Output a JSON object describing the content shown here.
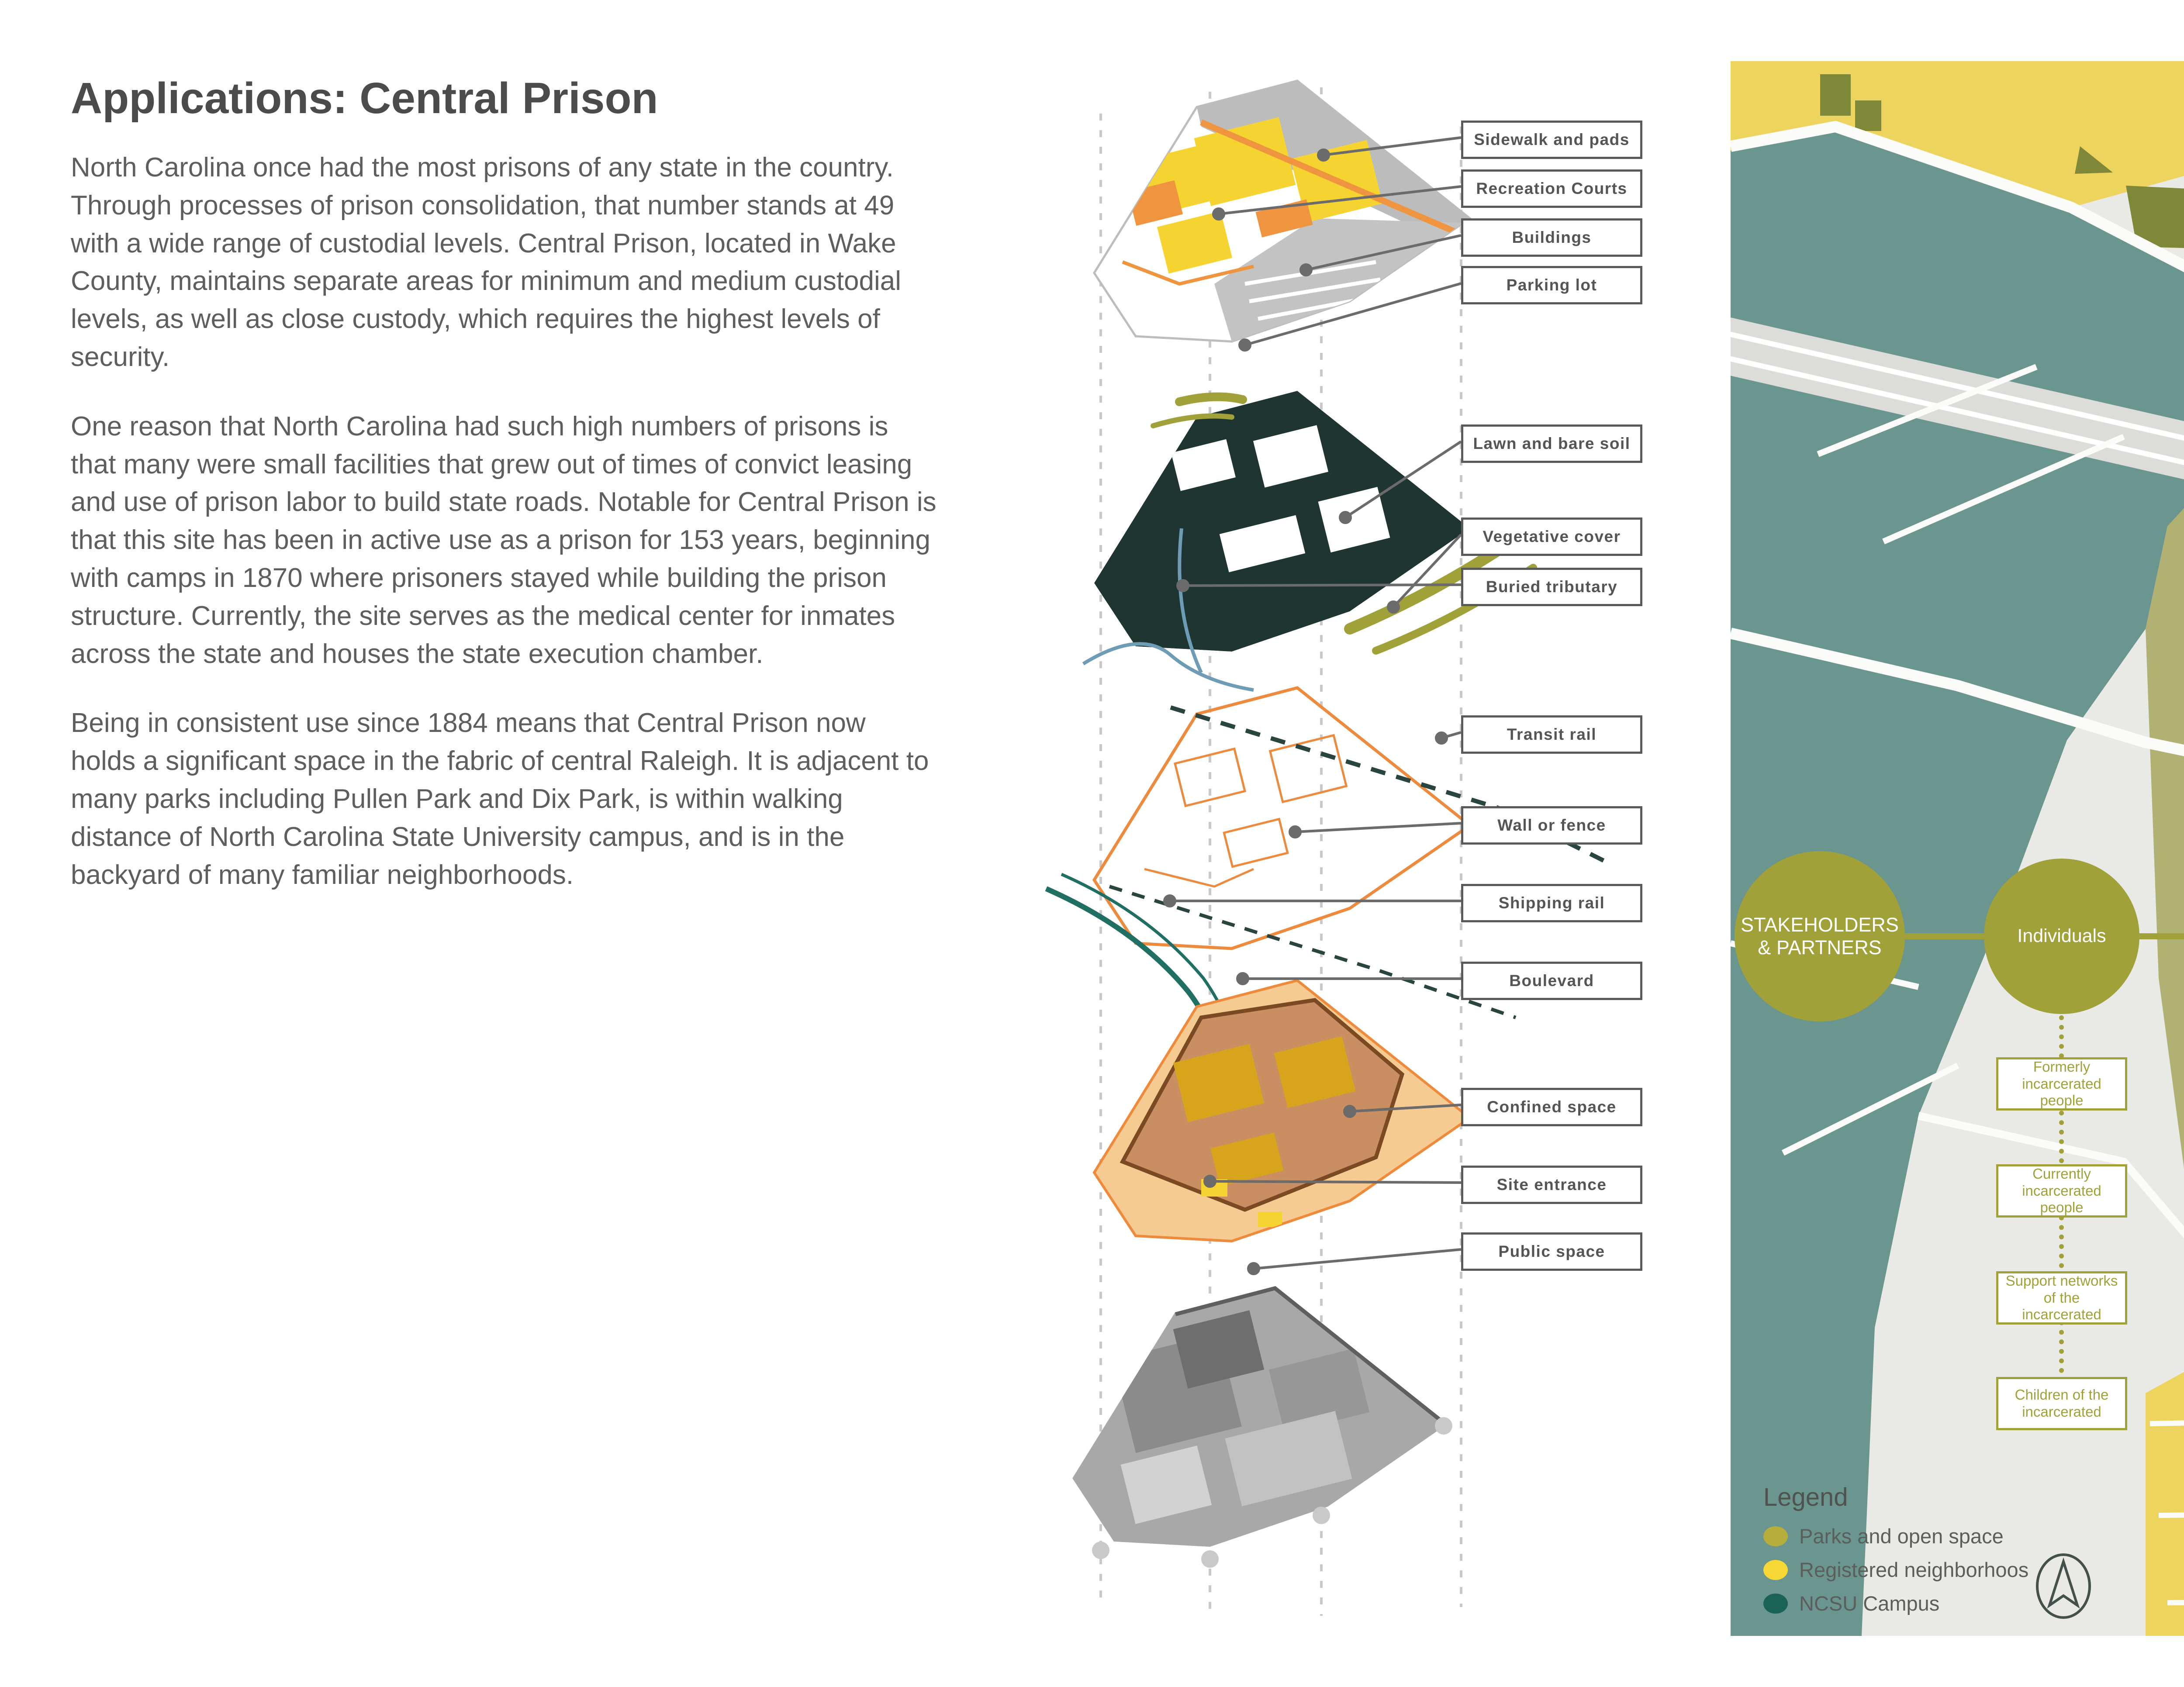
{
  "content": {
    "title": "Applications: Central Prison",
    "paragraphs": [
      "North Carolina once had the most prisons of any state in the country. Through processes of prison consolidation, that number stands at 49 with a wide range of custodial levels. Central Prison, located in Wake County, maintains separate areas for minimum and medium custodial levels, as well as close custody, which requires the highest levels of security.",
      "One reason that North Carolina had such high numbers of prisons is that many were small facilities that grew out of times of convict leasing and use of prison labor to build state roads. Notable for Central Prison is that this site has been in active use as a prison for 153 years, beginning with camps in 1870 where prisoners stayed while building the prison structure. Currently, the site serves as the medical center for inmates across the state and houses the state execution chamber.",
      "Being in consistent use since 1884 means that Central Prison now holds a significant space in the fabric of central Raleigh. It is adjacent to many parks including Pullen Park and Dix Park, is within walking distance of North Carolina State University campus, and is in the backyard of many familiar neighborhoods."
    ]
  },
  "diagram": {
    "labels": [
      "Sidewalk and pads",
      "Recreation Courts",
      "Buildings",
      "Parking lot",
      "Lawn and bare soil",
      "Vegetative cover",
      "Buried tributary",
      "Transit rail",
      "Wall or fence",
      "Shipping rail",
      "Boulevard",
      "Confined space",
      "Site entrance",
      "Public space"
    ]
  },
  "map": {
    "network": {
      "root": "STAKEHOLDERS & PARTNERS",
      "columns": [
        {
          "label": "Individuals",
          "items": [
            "Formerly incarcerated people",
            "Currently incarcerated people",
            "Support networks of the incarcerated",
            "Children of the incarcerated"
          ]
        },
        {
          "label": "Neighborhoods",
          "items": [
            "Kirby Bilyeu",
            "Boylan Heights",
            "Caraleigh",
            "Forest Park"
          ]
        },
        {
          "label": "Schools and Youth",
          "items": [
            "NCSU Students and Administration",
            "Morehead School Students and Admin",
            "Youth Empowered Solutions",
            "Restorative Justice Clinic Campbell Law"
          ]
        },
        {
          "label": "Government",
          "items": [
            "NC DHHS",
            "NC DOT",
            "NC DPS",
            "City of Raleigh Planning and Zoning"
          ]
        },
        {
          "label": "Justice and Reform Organizations",
          "items": [
            "Reentry Center for Women",
            "SARC Foundation",
            "NC Justice Center",
            "NC Harm Reduction Coalition",
            "Interfaith Prison Ministry for Women",
            "NC Harm Reduction Coalition"
          ]
        },
        {
          "label": "Other Racial and Social Justice Organizations",
          "items": [
            "NCEJN",
            "Capital Restorative Justice Project",
            "Disability RIghts North Carolina"
          ]
        }
      ]
    },
    "legend": {
      "title": "Legend",
      "items": [
        {
          "label": "Parks and open space",
          "color": "#b5ad3c"
        },
        {
          "label": "Registered neighborhoos",
          "color": "#f6d733"
        },
        {
          "label": "NCSU Campus",
          "color": "#1a6156"
        }
      ]
    }
  },
  "colors": {
    "accent_olive": "#a0a139",
    "map_yellow": "#ecd45f",
    "map_teal": "#6b958f",
    "park_olive": "#b0b172",
    "dark_olive": "#7e8838",
    "label_gray": "#555555"
  }
}
